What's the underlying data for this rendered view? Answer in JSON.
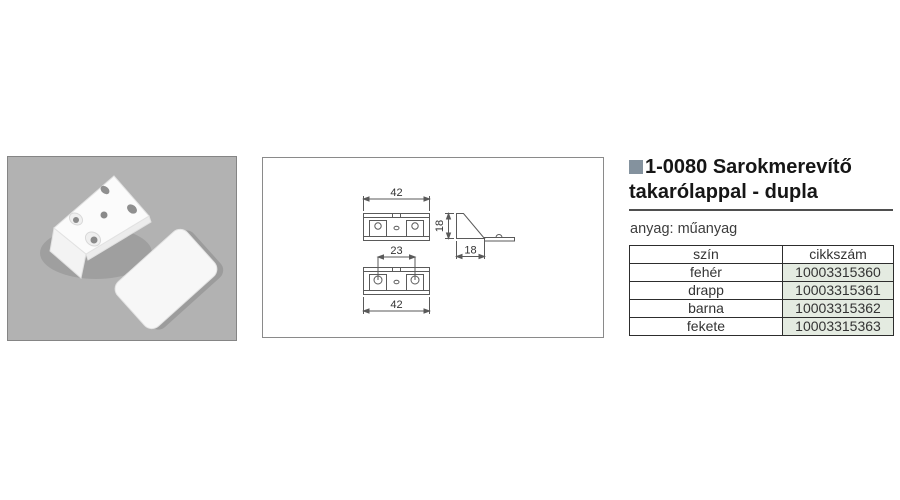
{
  "product": {
    "title_line1": "1-0080 Sarokmerevítő",
    "title_line2": "takarólappal - dupla",
    "material": "anyag: műanyag"
  },
  "table": {
    "headers": {
      "color": "szín",
      "sku": "cikkszám"
    },
    "rows": [
      {
        "color": "fehér",
        "sku": "10003315360"
      },
      {
        "color": "drapp",
        "sku": "10003315361"
      },
      {
        "color": "barna",
        "sku": "10003315362"
      },
      {
        "color": "fekete",
        "sku": "10003315363"
      }
    ]
  },
  "drawing": {
    "dim_width_top": "42",
    "dim_hole_spacing": "23",
    "dim_height": "18",
    "dim_depth": "18",
    "dim_width_bottom": "42"
  },
  "colors": {
    "title_bullet": "#84929e",
    "sku_cell_bg": "#e4ebe1",
    "table_border": "#2d2d2d",
    "photo_background": "#b2b2b2",
    "drawing_line": "#5a5a5a"
  }
}
